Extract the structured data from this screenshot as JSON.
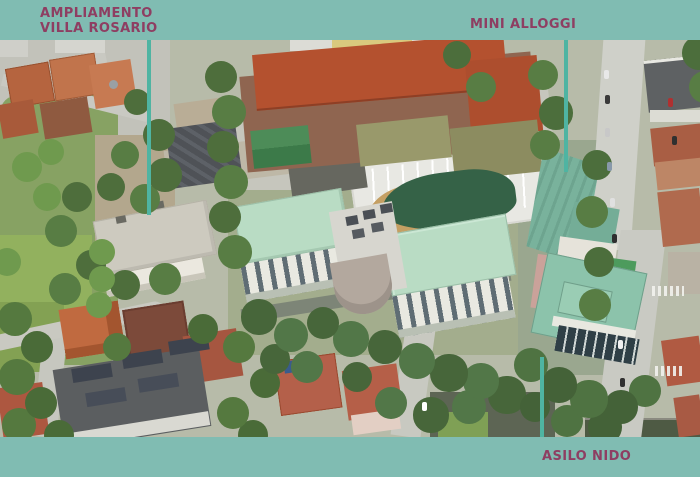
{
  "annotations": {
    "villa_rosario": {
      "line1": "AMPLIAMENTO",
      "line2": "VILLA ROSARIO"
    },
    "mini_alloggi": {
      "label": "MINI ALLOGGI"
    },
    "asilo_nido": {
      "label": "ASILO NIDO"
    }
  },
  "colors": {
    "frame_band": "#80bcb2",
    "leader_line": "#4fb4a2",
    "label_text": "#8e3e62"
  }
}
